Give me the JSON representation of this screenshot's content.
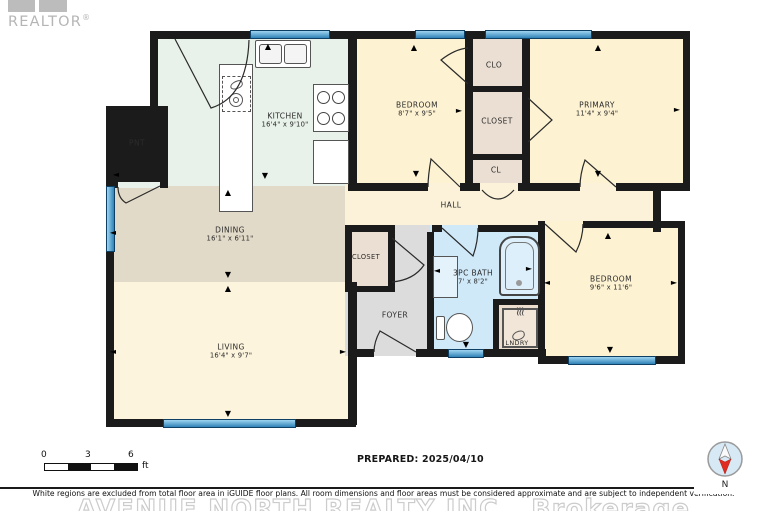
{
  "logo": {
    "brand": "REALTOR",
    "reg": "®"
  },
  "plan": {
    "rooms": {
      "kitchen": {
        "name": "KITCHEN",
        "dims": "16'4\" x 9'10\""
      },
      "pantry": {
        "name": "PNT"
      },
      "bedroom_top": {
        "name": "BEDROOM",
        "dims": "8'7\" x 9'5\""
      },
      "clo": {
        "name": "CLO"
      },
      "closet_top": {
        "name": "CLOSET"
      },
      "cl": {
        "name": "CL"
      },
      "primary": {
        "name": "PRIMARY",
        "dims": "11'4\" x 9'4\""
      },
      "dining": {
        "name": "DINING",
        "dims": "16'1\" x 6'11\""
      },
      "hall": {
        "name": "HALL"
      },
      "closet_mid": {
        "name": "CLOSET"
      },
      "foyer": {
        "name": "FOYER"
      },
      "bath": {
        "name": "3PC BATH",
        "dims": "7' x 8'2\""
      },
      "laundry": {
        "name": "LNDRY"
      },
      "bedroom_right": {
        "name": "BEDROOM",
        "dims": "9'6\" x 11'6\""
      },
      "living": {
        "name": "LIVING",
        "dims": "16'4\" x 9'7\""
      }
    },
    "compass_label": "N"
  },
  "footer": {
    "scale": {
      "ticks": [
        "0",
        "3",
        "6"
      ],
      "unit": "ft"
    },
    "prepared": "PREPARED: 2025/04/10",
    "disclaimer": "White regions are excluded from total floor area in iGUIDE floor plans. All room dimensions and floor areas must be considered approximate and are subject to independent verification.",
    "watermark": "AVENUE NORTH REALTY INC., Brokerage"
  },
  "colors": {
    "wall": "#1b1b1b",
    "window_blue": "#4aa0d4",
    "kitchen_mint": "#e8f1ea",
    "cream_room": "#fdf2d2",
    "dining_tan": "#e2dac8",
    "closet_beige": "#ebdfd3",
    "foyer_gray": "#dcdcdc",
    "bath_blue": "#cfe9f9",
    "compass_red": "#e02b20",
    "logo_gray": "#b5b5b5"
  }
}
